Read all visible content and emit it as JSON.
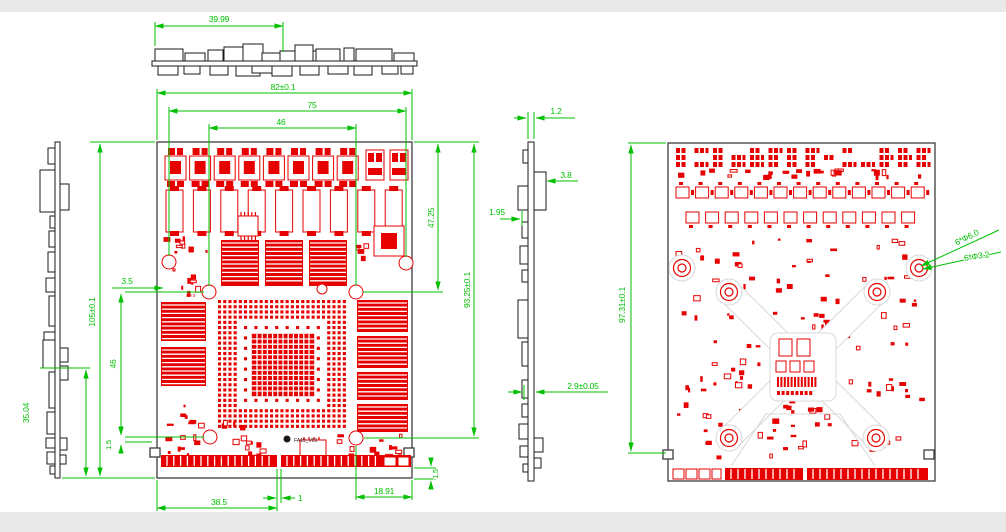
{
  "drawing": {
    "board_label": "FA19_V01",
    "refdes": {
      "a": "OY3",
      "b": "OY2"
    },
    "colors": {
      "pcb_red": "#e60000",
      "dimension_green": "#00c000",
      "outline_gray": "#3d3d3d",
      "profile_black": "#1a1a1a"
    }
  },
  "views": {
    "top_profile": {
      "dims": {
        "comp_width": "39.99"
      }
    },
    "left_profile": {
      "dims": {
        "comp_span": "35.04"
      }
    },
    "front": {
      "dims": {
        "board_width": "82±0.1",
        "hole_span": "75",
        "inner_span": "46",
        "right_upper": "47.25",
        "right_total": "93.25±0.1",
        "height_total": "105±0.1",
        "edge_offset": "3.5",
        "left_span": "46",
        "left_small": "1.5",
        "bottom_left": "38.5",
        "notch": "1",
        "bottom_right": "18.91",
        "right_small": "1.5"
      }
    },
    "side_profile": {
      "dims": {
        "pcb_thickness": "1.2",
        "comp_height": "3.8",
        "comp_offset": "1.95",
        "total_thickness": "2.9±0.05"
      }
    },
    "back": {
      "dims": {
        "height": "97.31±0.1",
        "hole_pad": "6*Φ6.0",
        "hole_drill": "6*Φ3.2"
      }
    }
  }
}
